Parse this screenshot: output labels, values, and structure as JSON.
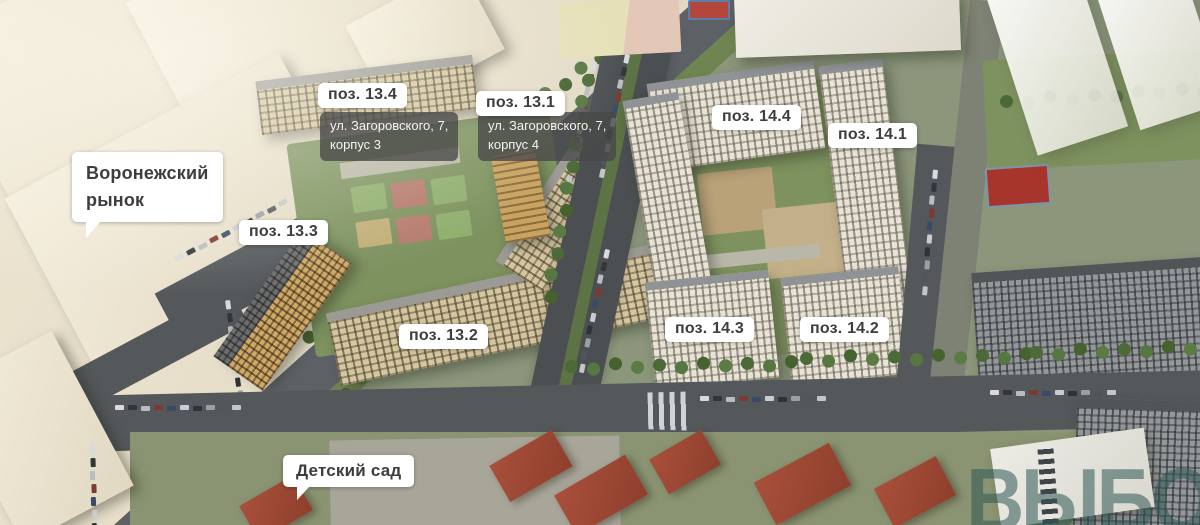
{
  "labels": {
    "pos_13_4": "поз. 13.4",
    "addr_13_4_line1": "ул. Загоровского, 7,",
    "addr_13_4_line2": "корпус 3",
    "pos_13_1": "поз. 13.1",
    "addr_13_1_line1": "ул. Загоровского, 7,",
    "addr_13_1_line2": "корпус 4",
    "pos_13_3": "поз. 13.3",
    "pos_13_2": "поз. 13.2",
    "pos_14_4": "поз. 14.4",
    "pos_14_1": "поз. 14.1",
    "pos_14_3": "поз. 14.3",
    "pos_14_2": "поз. 14.2",
    "market_line1": "Воронежский",
    "market_line2": "рынок",
    "kindergarten": "Детский сад",
    "watermark": "ВЫБОР"
  },
  "colors": {
    "label_bg": "#ffffff",
    "label_text": "#3d3d3d",
    "address_bg": "rgba(72,72,72,0.78)",
    "address_text": "#f4f4f4",
    "watermark_teal": "rgba(47,88,85,0.55)",
    "lawn_green": "#7d925f",
    "asphalt": "#54585b",
    "facade_beige": "#d5c69f",
    "facade_cream": "#efe7d5",
    "facade_bronze": "#d1a965",
    "roof_red": "#a8503c"
  }
}
